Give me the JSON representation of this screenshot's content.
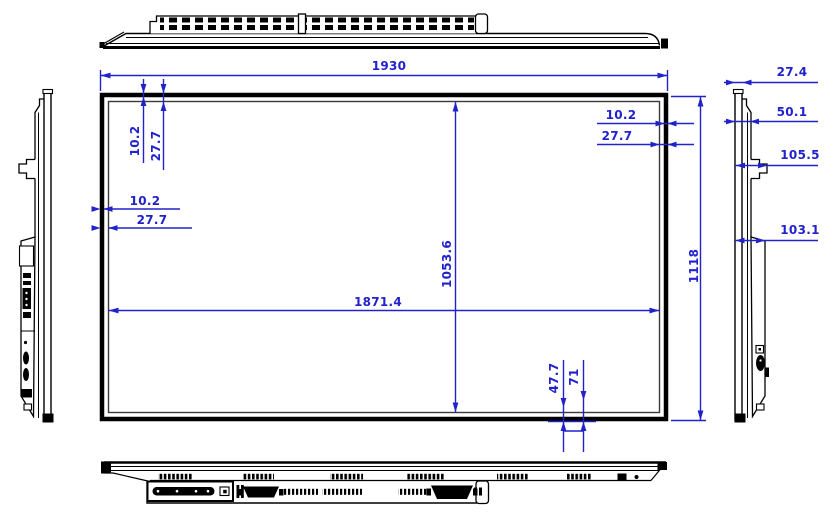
{
  "drawing": {
    "type": "engineering-dimension-drawing",
    "subject": "flat-panel-display",
    "colors": {
      "dimension": "#2222cc",
      "outline": "#000000"
    },
    "dims": {
      "front": {
        "width_total": "1930",
        "height_total": "1118",
        "width_active": "1871.4",
        "height_active": "1053.6",
        "bezel_top_a": "10.2",
        "bezel_top_b": "27.7",
        "bezel_left_a": "10.2",
        "bezel_left_b": "27.7",
        "bezel_right_a": "10.2",
        "bezel_right_b": "27.7",
        "bezel_bottom_a": "47.7",
        "bezel_bottom_b": "71"
      },
      "side": {
        "front_thickness": "27.4",
        "panel_depth": "50.1",
        "bracket_depth": "105.5",
        "body_depth": "103.1"
      }
    }
  }
}
